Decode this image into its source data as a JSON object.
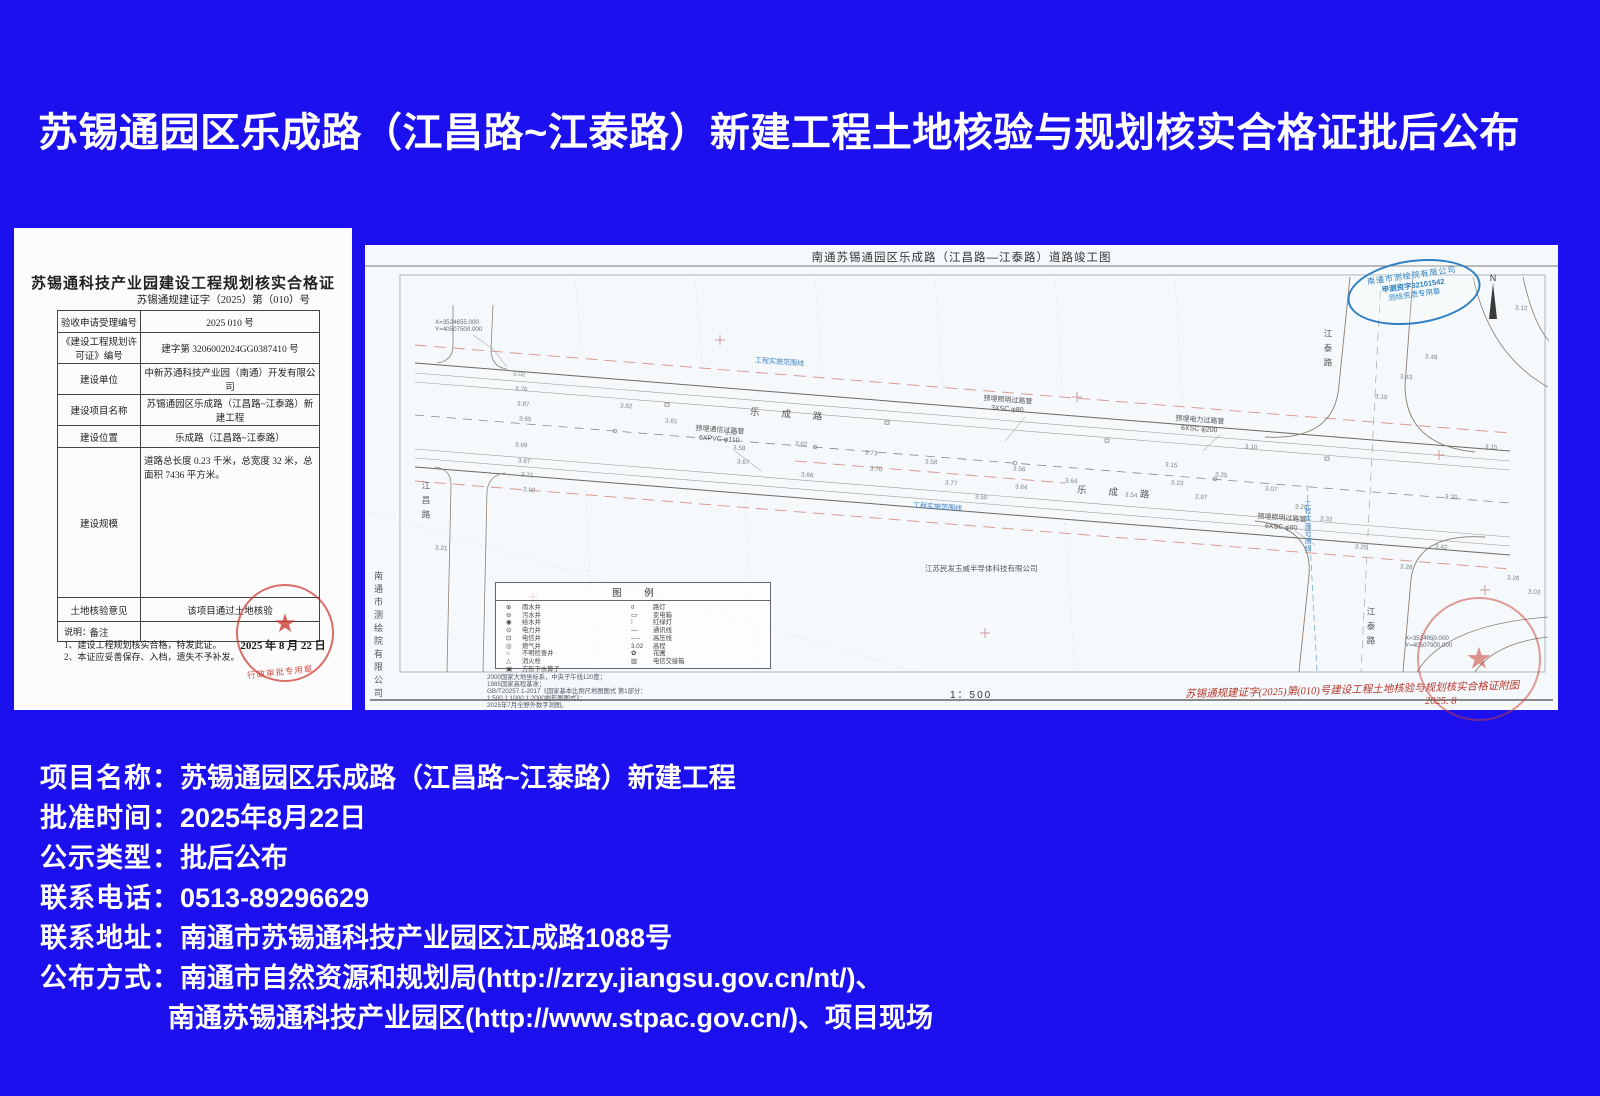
{
  "page": {
    "bg_color": "#1c11ee",
    "title": "苏锡通园区乐成路（江昌路~江泰路）新建工程土地核验与规划核实合格证批后公布"
  },
  "certificate": {
    "title": "苏锡通科技产业园建设工程规划核实合格证",
    "doc_number": "苏锡通规建证字（2025）第（010）号",
    "rows": [
      {
        "label": "验收申请受理编号",
        "value": "2025  010 号"
      },
      {
        "label": "《建设工程规划许可证》编号",
        "value": "建字第 3206002024GG0387410 号"
      },
      {
        "label": "建设单位",
        "value": "中新苏通科技产业园（南通）开发有限公司"
      },
      {
        "label": "建设项目名称",
        "value": "苏锡通园区乐成路（江昌路~江泰路）新建工程"
      },
      {
        "label": "建设位置",
        "value": "乐成路（江昌路~江泰路）"
      },
      {
        "label": "建设规模",
        "value": "道路总长度 0.23 千米，总宽度 32 米，总面积 7436 平方米。",
        "tall": true
      },
      {
        "label": "土地核验意见",
        "value": "该项目通过土地核验"
      },
      {
        "label": "备注",
        "value": ""
      }
    ],
    "notes_title": "说明：",
    "notes": [
      "1、建设工程规划核实合格，特发此证。",
      "2、本证应妥善保存、入档，遗失不予补发。"
    ],
    "stamp_date": "2025 年 8 月 22 日",
    "stamp_label": "行政审批专用章"
  },
  "map": {
    "title": "南通苏锡通园区乐成路（江昌路—江泰路）道路竣工图",
    "left_vertical_company": "南通市测绘院有限公司",
    "surveyor_stamp": {
      "line1": "南通市测绘院有限公司",
      "line2": "甲测资字32101542",
      "line3": "测绘资质专用章"
    },
    "north_label": "N",
    "scale": "1：500",
    "legend_title": "图  例",
    "legend_left": [
      {
        "sym": "⊕",
        "label": "雨水井"
      },
      {
        "sym": "⊖",
        "label": "污水井"
      },
      {
        "sym": "◉",
        "label": "给水井"
      },
      {
        "sym": "⊙",
        "label": "电力井"
      },
      {
        "sym": "⊡",
        "label": "电信井"
      },
      {
        "sym": "◎",
        "label": "燃气井"
      },
      {
        "sym": "○",
        "label": "不明检查井"
      },
      {
        "sym": "△",
        "label": "消火栓"
      },
      {
        "sym": "▣",
        "label": "方形下水箅子"
      }
    ],
    "legend_right": [
      {
        "sym": "¤",
        "label": "路灯"
      },
      {
        "sym": "▭",
        "label": "变电箱"
      },
      {
        "sym": "⁞",
        "label": "红绿灯"
      },
      {
        "sym": "—",
        "label": "通讯线"
      },
      {
        "sym": "–·–",
        "label": "高压线"
      },
      {
        "sym": "3.02",
        "label": "高程"
      },
      {
        "sym": "✿",
        "label": "花圃"
      },
      {
        "sym": "▥",
        "label": "电信交接箱"
      }
    ],
    "notes": [
      "2000国家大地坐标系，中央子午线120度；",
      "1985国家高程基准；",
      "GB/T20257.1-2017《国家基本比例尺地图图式 第1部分：",
      "1:500 1:1000 1:2000地形图图式》；",
      "2025年7月全野外数字测图。"
    ],
    "coord_top_left": {
      "x": "X=3524655.000",
      "y": "Y=40507500.000"
    },
    "coord_bottom_right": {
      "x": "X=3524050.000",
      "y": "Y=40507900.000"
    },
    "labels": {
      "boundary": "工程实施范围线",
      "road_main": "乐成路",
      "road_left": "江昌路",
      "road_right": "江泰路",
      "company": "江苏民发玉威半导体科技有限公司",
      "pipe1": {
        "line1": "预埋照明过路管",
        "line2": "3XSC φ80"
      },
      "pipe2": {
        "line1": "预埋通信过路管",
        "line2": "6XPVC φ110"
      },
      "pipe3": {
        "line1": "预埋电力过路管",
        "line2": "6XSC φ200"
      },
      "pipe4": {
        "line1": "预埋照明过路管",
        "line2": "6XSC φ80"
      }
    },
    "annotation_red": "苏锡通规建证字(2025)第(010)号建设工程土地核验与规划核实合格证附图",
    "annotation_red_date": "2025. 8",
    "spot_elevations": [
      {
        "x": 148,
        "y": 126,
        "v": "3.02"
      },
      {
        "x": 150,
        "y": 141,
        "v": "3.76"
      },
      {
        "x": 152,
        "y": 156,
        "v": "3.87"
      },
      {
        "x": 154,
        "y": 171,
        "v": "3.65"
      },
      {
        "x": 150,
        "y": 197,
        "v": "3.69"
      },
      {
        "x": 153,
        "y": 213,
        "v": "3.67"
      },
      {
        "x": 156,
        "y": 227,
        "v": "3.71"
      },
      {
        "x": 158,
        "y": 242,
        "v": "3.92"
      },
      {
        "x": 255,
        "y": 158,
        "v": "3.82"
      },
      {
        "x": 300,
        "y": 173,
        "v": "3.61"
      },
      {
        "x": 360,
        "y": 185,
        "v": "3.62"
      },
      {
        "x": 368,
        "y": 200,
        "v": "3.58"
      },
      {
        "x": 372,
        "y": 214,
        "v": "3.67"
      },
      {
        "x": 430,
        "y": 196,
        "v": "3.62"
      },
      {
        "x": 436,
        "y": 227,
        "v": "3.66"
      },
      {
        "x": 500,
        "y": 205,
        "v": "3.73"
      },
      {
        "x": 505,
        "y": 221,
        "v": "3.70"
      },
      {
        "x": 560,
        "y": 214,
        "v": "3.58"
      },
      {
        "x": 580,
        "y": 235,
        "v": "3.77"
      },
      {
        "x": 610,
        "y": 249,
        "v": "3.50"
      },
      {
        "x": 648,
        "y": 221,
        "v": "3.56"
      },
      {
        "x": 650,
        "y": 239,
        "v": "3.64"
      },
      {
        "x": 700,
        "y": 233,
        "v": "3.64"
      },
      {
        "x": 760,
        "y": 247,
        "v": "3.54"
      },
      {
        "x": 800,
        "y": 217,
        "v": "3.15"
      },
      {
        "x": 806,
        "y": 235,
        "v": "3.23"
      },
      {
        "x": 830,
        "y": 249,
        "v": "2.97"
      },
      {
        "x": 850,
        "y": 227,
        "v": "3.25"
      },
      {
        "x": 880,
        "y": 199,
        "v": "3.10"
      },
      {
        "x": 900,
        "y": 241,
        "v": "3.07"
      },
      {
        "x": 930,
        "y": 259,
        "v": "3.26"
      },
      {
        "x": 955,
        "y": 271,
        "v": "3.32"
      },
      {
        "x": 990,
        "y": 299,
        "v": "3.25"
      },
      {
        "x": 1035,
        "y": 319,
        "v": "3.28"
      },
      {
        "x": 1070,
        "y": 299,
        "v": "3.42"
      },
      {
        "x": 1080,
        "y": 249,
        "v": "3.20"
      },
      {
        "x": 1010,
        "y": 149,
        "v": "3.19"
      },
      {
        "x": 1035,
        "y": 129,
        "v": "3.43"
      },
      {
        "x": 1060,
        "y": 109,
        "v": "3.48"
      },
      {
        "x": 1120,
        "y": 199,
        "v": "3.15"
      },
      {
        "x": 1142,
        "y": 330,
        "v": "3.26"
      },
      {
        "x": 1163,
        "y": 344,
        "v": "3.03"
      },
      {
        "x": 1150,
        "y": 60,
        "v": "3.12"
      },
      {
        "x": 70,
        "y": 300,
        "v": "3.21"
      }
    ]
  },
  "footer": {
    "lines": [
      {
        "label": "项目名称：",
        "value": "苏锡通园区乐成路（江昌路~江泰路）新建工程"
      },
      {
        "label": "批准时间：",
        "value": "2025年8月22日"
      },
      {
        "label": "公示类型：",
        "value": "批后公布"
      },
      {
        "label": "联系电话：",
        "value": "0513-89296629"
      },
      {
        "label": "联系地址：",
        "value": "南通市苏锡通科技产业园区江成路1088号"
      },
      {
        "label": "公布方式：",
        "value": "南通市自然资源和规划局(http://zrzy.jiangsu.gov.cn/nt/)、"
      },
      {
        "label": "",
        "value": "南通苏锡通科技产业园区(http://www.stpac.gov.cn/)、项目现场"
      }
    ]
  }
}
